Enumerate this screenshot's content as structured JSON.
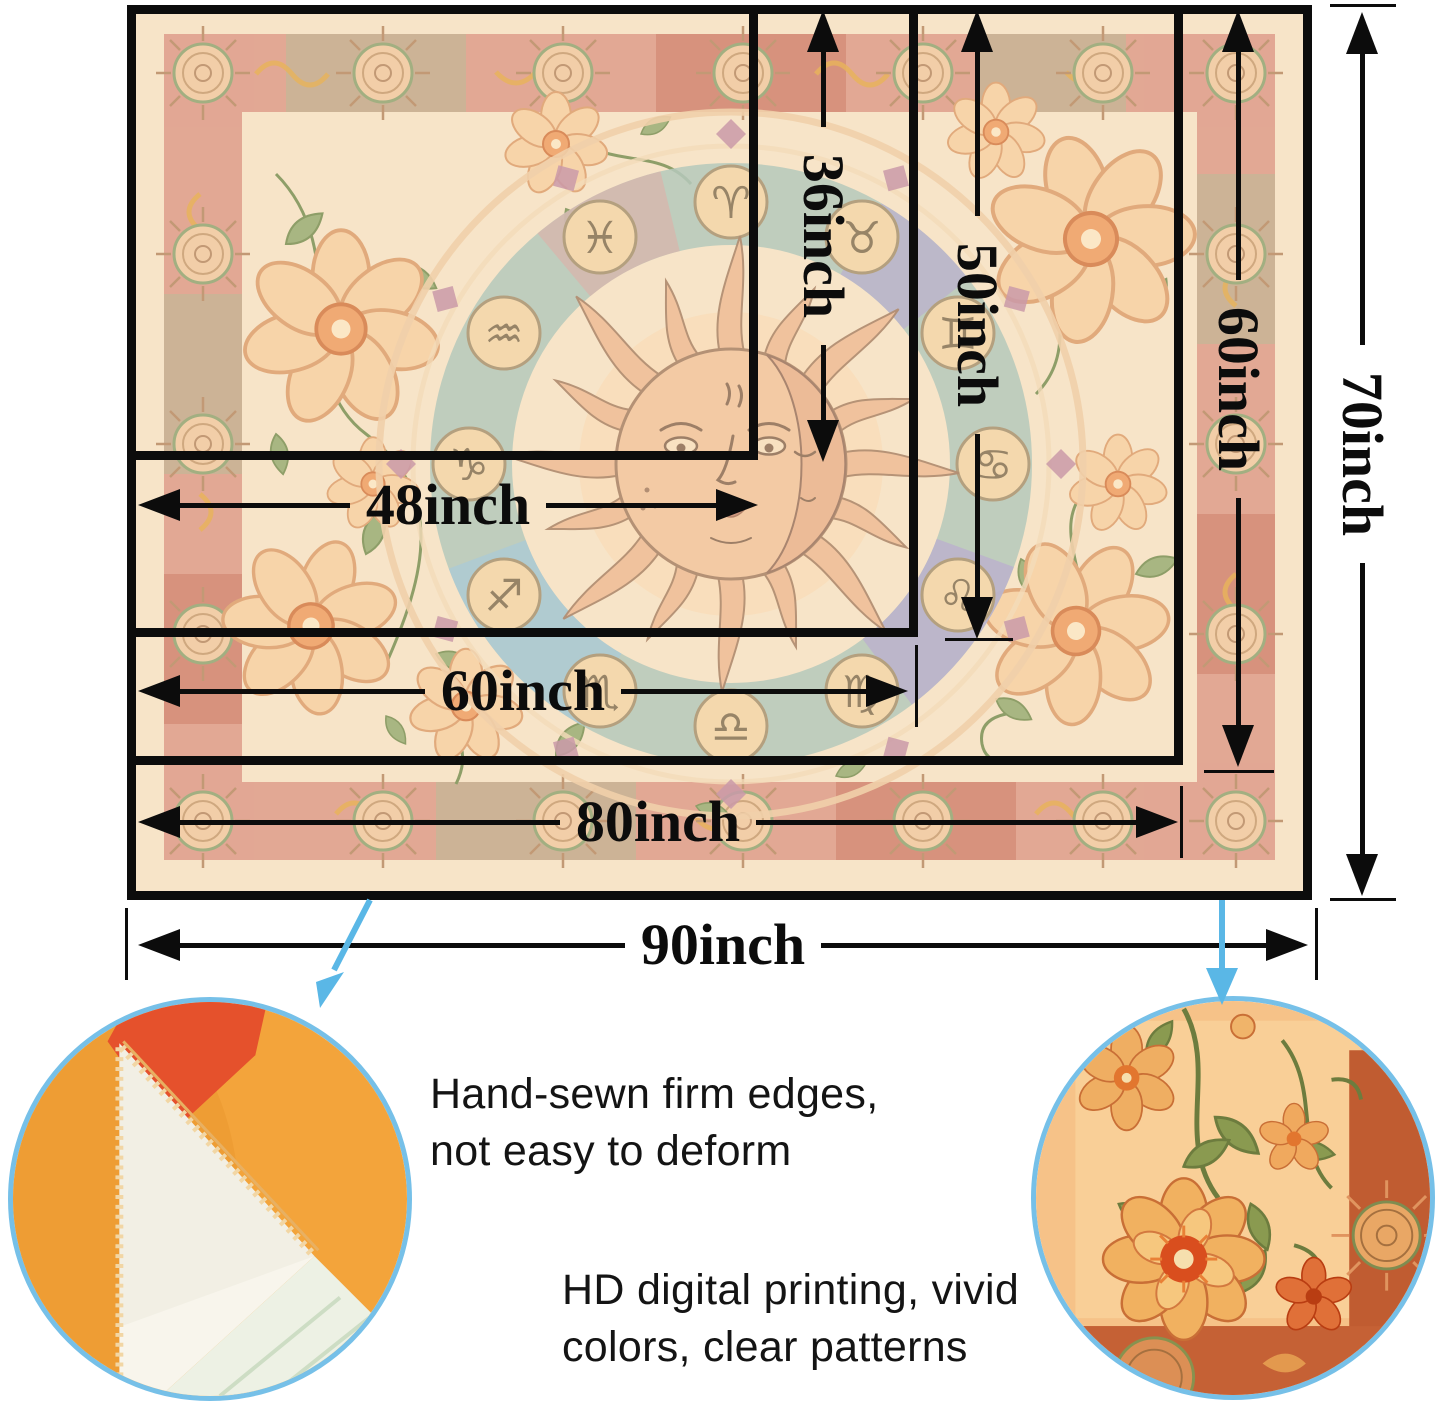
{
  "dims": {
    "h": [
      "48inch",
      "60inch",
      "80inch",
      "90inch"
    ],
    "v": [
      "36inch",
      "50inch",
      "60inch",
      "70inch"
    ]
  },
  "features": [
    {
      "icon": "fabric-edge-closeup",
      "lines": [
        "Hand-sewn firm edges,",
        "not easy to deform"
      ]
    },
    {
      "icon": "pattern-closeup",
      "lines": [
        "HD digital printing, vivid",
        "colors, clear patterns"
      ]
    }
  ],
  "zodiac": [
    "♈",
    "♉",
    "♊",
    "♋",
    "♌",
    "♍",
    "♎",
    "♏",
    "♐",
    "♑",
    "♒",
    "♓"
  ],
  "colors": {
    "dimension_line": "#0c0c0c",
    "callout_arrow": "#5ab7e6",
    "circle_border": "#76c0e8",
    "tapestry_cream": "#f6e0bf",
    "band_salmon": "#db907b",
    "sun_line_art": "#a67c5c"
  }
}
